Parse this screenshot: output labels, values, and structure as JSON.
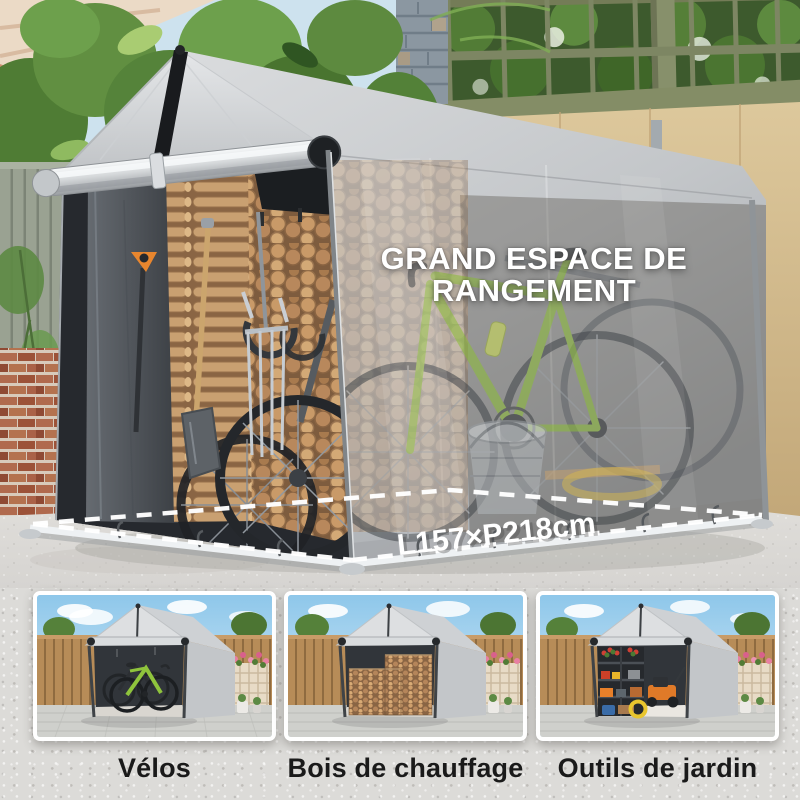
{
  "hero": {
    "headline_line1": "GRAND ESPACE DE",
    "headline_line2": "RANGEMENT",
    "dimension_label": "L157×P218cm"
  },
  "thumbnails": [
    {
      "caption": "Vélos"
    },
    {
      "caption": "Bois de chauffage"
    },
    {
      "caption": "Outils de jardin"
    }
  ],
  "colors": {
    "headline_text": "#ffffff",
    "caption_text": "#1a1a1a",
    "tarp_grey": "#c9ccce",
    "accent_green_bike": "#8fc43c",
    "firewood_tan": "#c99a68",
    "concrete": "#dcdbd8"
  }
}
